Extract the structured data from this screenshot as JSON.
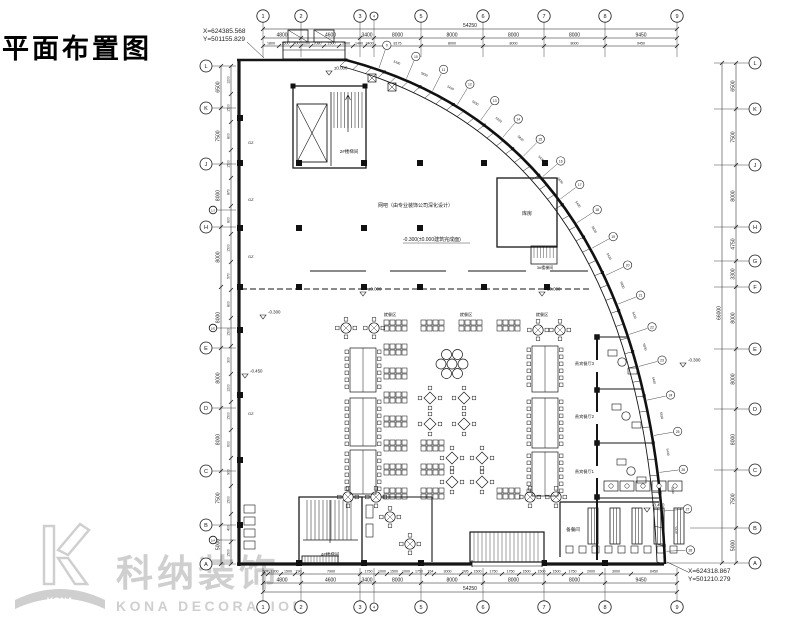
{
  "title": "平面布置图",
  "survey": {
    "top_x": "X=624385.568",
    "top_y": "Y=501155.829",
    "bot_x": "X=624318.867",
    "bot_y": "Y=501210.279"
  },
  "watermark": {
    "cn": "科纳装饰",
    "en": "KONA DECORATION",
    "logo_text": "KONA"
  },
  "grid": {
    "top": {
      "total": "54250",
      "bubbles": [
        "1",
        "2",
        "3",
        "4",
        "5",
        "6",
        "7",
        "8",
        "9"
      ],
      "dims": [
        "4800",
        "4600",
        "3400",
        "8000",
        "8000",
        "8000",
        "8000",
        "9450"
      ],
      "subdims": [
        "1800",
        "1500",
        "400",
        "1200",
        "2080",
        "1500",
        "1900",
        "1400",
        "3400",
        "8175",
        "8000",
        "8000",
        "8000",
        "9450"
      ]
    },
    "bottom": {
      "total": "54250",
      "bubbles": [
        "1",
        "2",
        "3",
        "4",
        "5",
        "6",
        "7",
        "8",
        "9"
      ],
      "dims": [
        "4800",
        "4600",
        "3400",
        "8000",
        "8000",
        "8000",
        "8000",
        "9450"
      ],
      "subdims": [
        "507",
        "1300",
        "1500",
        "790",
        "7900",
        "1750",
        "1000",
        "1500",
        "1000",
        "1750",
        "764",
        "3000",
        "995",
        "1500",
        "1750",
        "1750",
        "1500",
        "1500",
        "1500",
        "1750",
        "2000",
        "3000",
        "6450"
      ]
    },
    "left": {
      "bubbles": [
        "L",
        "K",
        "J",
        "H",
        "E",
        "D",
        "C",
        "B",
        "A"
      ],
      "sub_bubbles": [
        "1/J",
        "1/E",
        "1/A"
      ],
      "dims": [
        "6500",
        "7500",
        "8000",
        "8000",
        "8000",
        "8000",
        "8000",
        "7500",
        "5000"
      ],
      "subdims": [
        "1200",
        "1500",
        "800",
        "1500",
        "870",
        "800",
        "1500",
        "570",
        "800",
        "1500",
        "300",
        "1200",
        "1500",
        "600",
        "900",
        "1500",
        "400",
        "1500"
      ]
    },
    "right": {
      "total": "66000",
      "bubbles": [
        "L",
        "K",
        "J",
        "H",
        "G",
        "F",
        "E",
        "D",
        "C",
        "B",
        "A"
      ],
      "dims": [
        "6500",
        "7500",
        "8000",
        "4750",
        "3300",
        "8000",
        "8000",
        "8000",
        "7500",
        "5000"
      ]
    },
    "radial": {
      "bubbles": [
        "9",
        "10",
        "11",
        "12",
        "13",
        "14",
        "15",
        "16",
        "17",
        "18",
        "19",
        "20",
        "21",
        "22",
        "23",
        "24",
        "25",
        "26",
        "27",
        "28"
      ],
      "panel_dims": [
        "5430",
        "5830"
      ]
    }
  },
  "annotations": {
    "labels": [
      {
        "t": "网吧（由专业装饰公司深化设计）",
        "x": 378,
        "y": 207,
        "s": 5,
        "a": "start"
      },
      {
        "t": "-0.300(±0.000建筑完成面)",
        "x": 403,
        "y": 241,
        "s": 5,
        "a": "start"
      },
      {
        "t": "2#楼梯间",
        "x": 349,
        "y": 153,
        "s": 4.5,
        "a": "middle"
      },
      {
        "t": "3#楼梯间",
        "x": 545,
        "y": 269,
        "s": 4,
        "a": "middle"
      },
      {
        "t": "4#楼梯间",
        "x": 330,
        "y": 556,
        "s": 4.5,
        "a": "middle"
      },
      {
        "t": "库房",
        "x": 527,
        "y": 215,
        "s": 5,
        "a": "middle"
      },
      {
        "t": "就餐区",
        "x": 390,
        "y": 316,
        "s": 4.2,
        "a": "middle"
      },
      {
        "t": "就餐区",
        "x": 466,
        "y": 316,
        "s": 4.2,
        "a": "middle"
      },
      {
        "t": "就餐区",
        "x": 542,
        "y": 316,
        "s": 4.2,
        "a": "middle"
      },
      {
        "t": "贵宾餐厅3",
        "x": 594,
        "y": 365,
        "s": 4.2,
        "a": "end"
      },
      {
        "t": "贵宾餐厅2",
        "x": 594,
        "y": 418,
        "s": 4.2,
        "a": "end"
      },
      {
        "t": "贵宾餐厅1",
        "x": 594,
        "y": 473,
        "s": 4.2,
        "a": "end"
      },
      {
        "t": "备餐间",
        "x": 573,
        "y": 531,
        "s": 4.6,
        "a": "middle"
      },
      {
        "t": "GZ",
        "x": 248,
        "y": 144,
        "s": 4,
        "a": "start"
      },
      {
        "t": "GZ",
        "x": 248,
        "y": 201,
        "s": 4,
        "a": "start"
      },
      {
        "t": "GZ",
        "x": 248,
        "y": 258,
        "s": 4,
        "a": "start"
      },
      {
        "t": "GZ",
        "x": 248,
        "y": 415,
        "s": 4,
        "a": "start"
      }
    ],
    "elevations": [
      {
        "v": "±0.000",
        "x": 334,
        "y": 75
      },
      {
        "v": "-0.300",
        "x": 268,
        "y": 319
      },
      {
        "v": "-0.450",
        "x": 250,
        "y": 378
      },
      {
        "v": "±0.000",
        "x": 368,
        "y": 296
      },
      {
        "v": "±0.000",
        "x": 547,
        "y": 296
      },
      {
        "v": "-0.300",
        "x": 688,
        "y": 367
      },
      {
        "v": "-0.450",
        "x": 652,
        "y": 512
      }
    ]
  }
}
